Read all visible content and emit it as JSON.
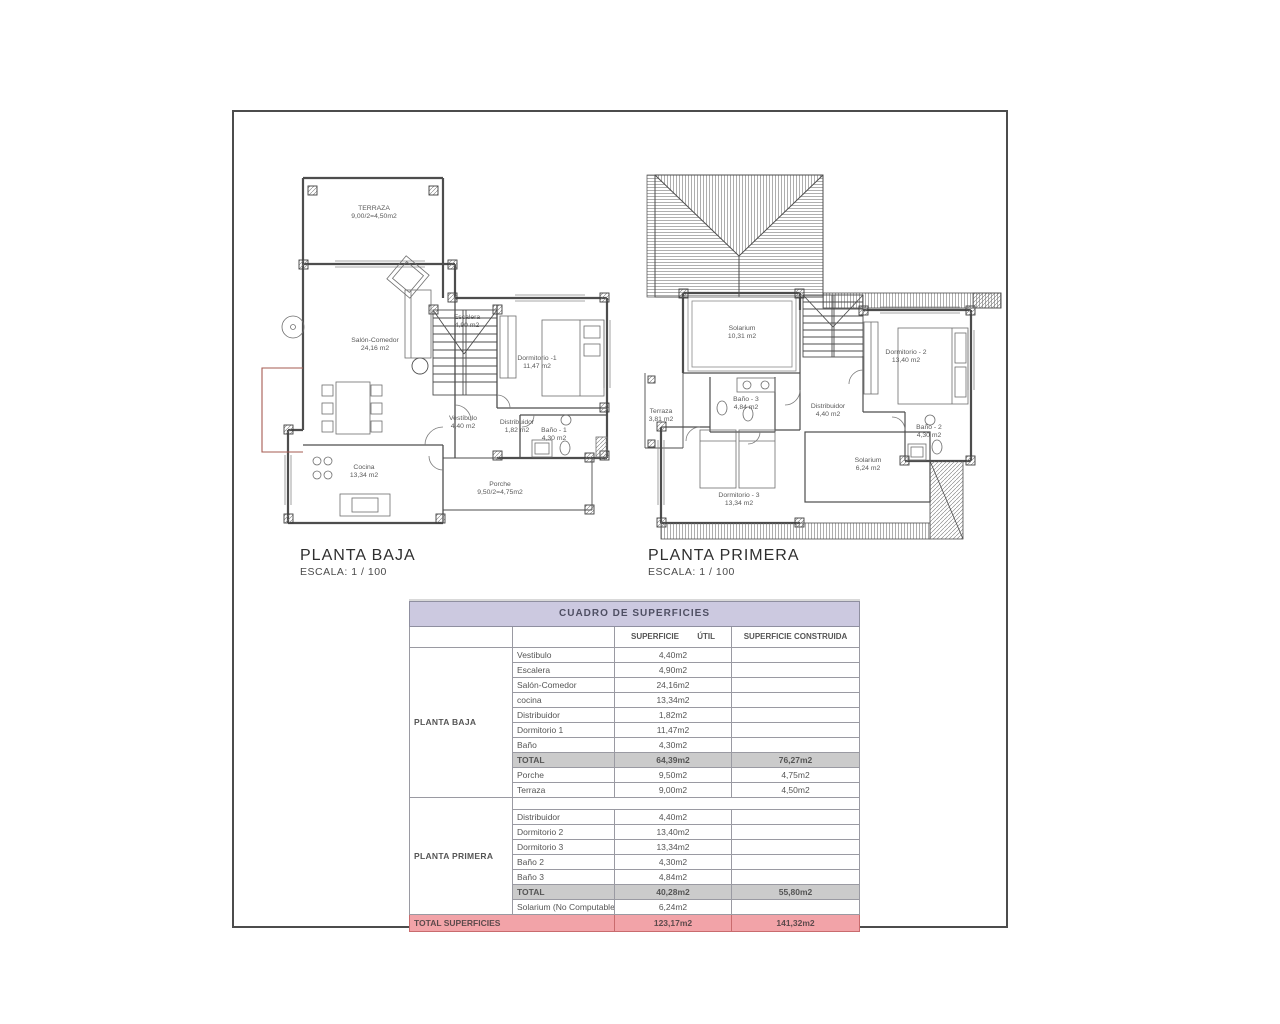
{
  "plans": {
    "baja": {
      "title": "PLANTA BAJA",
      "scale": "ESCALA: 1 / 100",
      "labels": {
        "terraza": {
          "name": "TERRAZA",
          "area": "9,00/2=4,50m2"
        },
        "salon": {
          "name": "Salón-Comedor",
          "area": "24,16 m2"
        },
        "escalera": {
          "name": "Escalera",
          "area": "4,90 m2"
        },
        "dormitorio1": {
          "name": "Dormitorio -1",
          "area": "11,47 m2"
        },
        "vestibulo": {
          "name": "Vestíbulo",
          "area": "4,40 m2"
        },
        "distribuidor": {
          "name": "Distribuidor",
          "area": "1,82 m2"
        },
        "bano1": {
          "name": "Baño - 1",
          "area": "4,30 m2"
        },
        "cocina": {
          "name": "Cocina",
          "area": "13,34 m2"
        },
        "porche": {
          "name": "Porche",
          "area": "9,50/2=4,75m2"
        }
      }
    },
    "primera": {
      "title": "PLANTA PRIMERA",
      "scale": "ESCALA: 1 / 100",
      "labels": {
        "solarium": {
          "name": "Solarium",
          "area": "10,31 m2"
        },
        "dormitorio2": {
          "name": "Dormitorio - 2",
          "area": "13,40 m2"
        },
        "terraza": {
          "name": "Terraza",
          "area": "3,81 m2"
        },
        "bano3": {
          "name": "Baño - 3",
          "area": "4,84 m2"
        },
        "distribuidor": {
          "name": "Distribuidor",
          "area": "4,40 m2"
        },
        "bano2": {
          "name": "Baño - 2",
          "area": "4,30 m2"
        },
        "dormitorio3": {
          "name": "Dormitorio - 3",
          "area": "13,34 m2"
        },
        "solarium_nc": {
          "name": "Solarium",
          "area": "6,24 m2"
        }
      }
    }
  },
  "table": {
    "title": "CUADRO DE SUPERFICIES",
    "headers": {
      "util": "SUPERFICIE ÚTIL",
      "construida": "SUPERFICIE CONSTRUIDA"
    },
    "sections": [
      {
        "floor": "PLANTA BAJA",
        "rows": [
          {
            "name": "Vestibulo",
            "util": "4,40m2",
            "cons": ""
          },
          {
            "name": "Escalera",
            "util": "4,90m2",
            "cons": ""
          },
          {
            "name": "Salón-Comedor",
            "util": "24,16m2",
            "cons": ""
          },
          {
            "name": "cocina",
            "util": "13,34m2",
            "cons": ""
          },
          {
            "name": "Distribuidor",
            "util": "1,82m2",
            "cons": ""
          },
          {
            "name": "Dormitorio 1",
            "util": "11,47m2",
            "cons": ""
          },
          {
            "name": "Baño",
            "util": "4,30m2",
            "cons": ""
          },
          {
            "name": "TOTAL",
            "util": "64,39m2",
            "cons": "76,27m2"
          },
          {
            "name": "Porche",
            "util": "9,50m2",
            "cons": "4,75m2"
          },
          {
            "name": "Terraza",
            "util": "9,00m2",
            "cons": "4,50m2"
          }
        ]
      },
      {
        "floor": "PLANTA PRIMERA",
        "rows": [
          {
            "name": "Distribuidor",
            "util": "4,40m2",
            "cons": ""
          },
          {
            "name": "Dormitorio 2",
            "util": "13,40m2",
            "cons": ""
          },
          {
            "name": "Dormitorio 3",
            "util": "13,34m2",
            "cons": ""
          },
          {
            "name": "Baño 2",
            "util": "4,30m2",
            "cons": ""
          },
          {
            "name": "Baño 3",
            "util": "4,84m2",
            "cons": ""
          },
          {
            "name": "TOTAL",
            "util": "40,28m2",
            "cons": "55,80m2"
          },
          {
            "name": "Solarium (No Computable)",
            "util": "6,24m2",
            "cons": ""
          }
        ]
      }
    ],
    "grand": {
      "label": "TOTAL SUPERFICIES",
      "util": "123,17m2",
      "cons": "141,32m2"
    },
    "colors": {
      "header_bg": "#ccc9e0",
      "total_bg": "#cbcbcb",
      "grand_bg": "#f2a3a8",
      "grand_border": "#c96b6e",
      "line": "#4c4c4c"
    }
  }
}
